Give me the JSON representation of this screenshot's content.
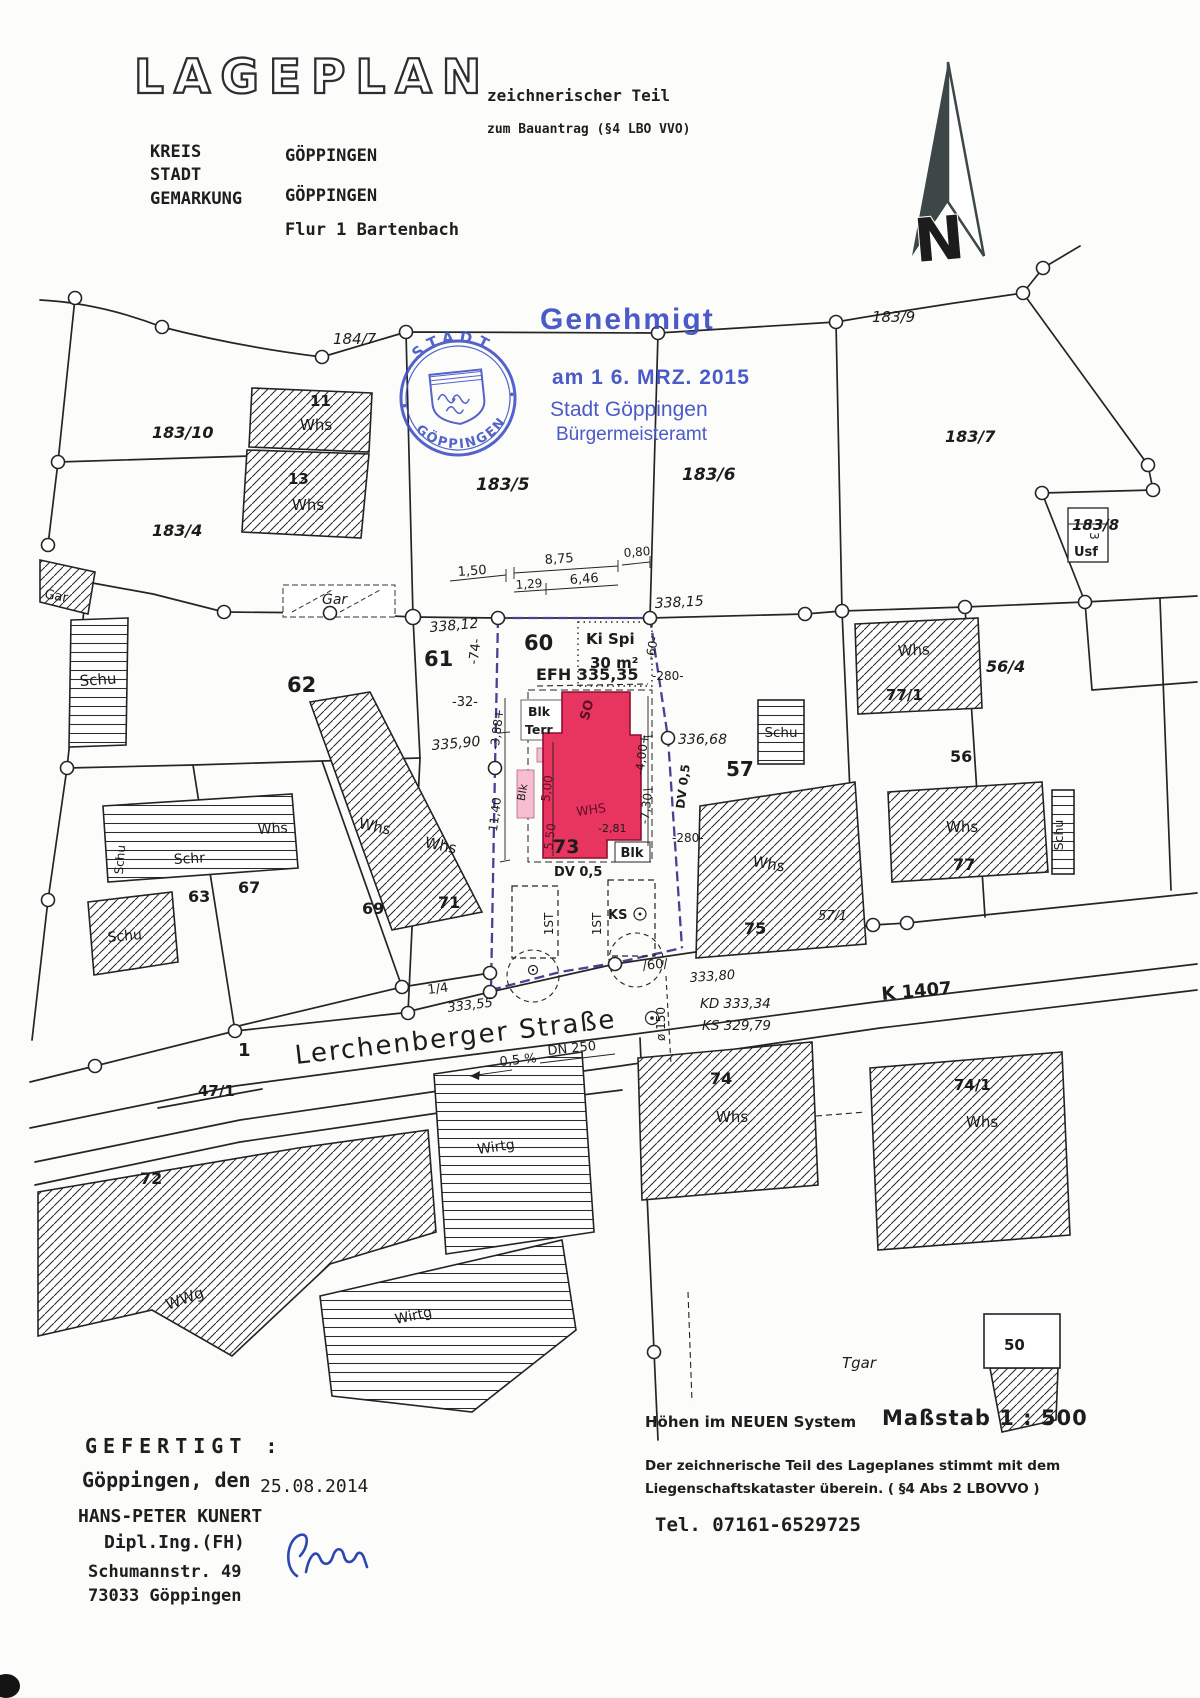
{
  "header": {
    "title": "LAGEPLAN",
    "subtitle": "zeichnerischer Teil",
    "subtitle2": "zum Bauantrag (§4 LBO VVO)",
    "kreis_label": "KREIS",
    "stadt_label": "STADT",
    "gemarkung_label": "GEMARKUNG",
    "kreis_value": "GÖPPINGEN",
    "gemarkung_value": "GÖPPINGEN",
    "flur_value": "Flur 1  Bartenbach"
  },
  "stamp": {
    "approved": "Genehmigt",
    "date_line": "am 1 6. MRZ. 2015",
    "authority": "Stadt Göppingen",
    "office": "Bürgermeisteramt",
    "seal_top": "STADT",
    "seal_bottom": "GÖPPINGEN",
    "color": "#3d4fc4"
  },
  "north": {
    "letter": "N"
  },
  "map": {
    "street_name": "Lerchenberger Straße",
    "road_k": "K 1407",
    "p184_7": "184/7",
    "p183_9": "183/9",
    "p183_10": "183/10",
    "p183_4": "183/4",
    "p183_5": "183/5",
    "p183_6": "183/6",
    "p183_7": "183/7",
    "p183_8": "183/8",
    "p56_4": "56/4",
    "p56": "56",
    "p57": "57",
    "p57_1": "57/1",
    "p60": "60",
    "p61": "61",
    "p62": "62",
    "p63": "63",
    "p67": "67",
    "p69": "69",
    "p71": "71",
    "p73": "73",
    "p75": "75",
    "p77": "77",
    "p77_1": "77/1",
    "p72": "72",
    "p74": "74",
    "p74_1": "74/1",
    "p50": "50",
    "p47_1": "47/1",
    "p1": "1",
    "p1_4": "1/4",
    "p11": "11",
    "p13": "13",
    "whs": "Whs",
    "whs_caps": "WHS",
    "schu": "Schu",
    "schr": "Schr",
    "gar": "Gar",
    "usf": "Usf",
    "usf_num": "3",
    "wwg": "WWg",
    "wirtg": "Wirtg",
    "tgar": "Tgar",
    "terr": "Terr",
    "blk": "Blk",
    "so": "SO",
    "st1": "1ST",
    "ks": "KS",
    "dv05": "DV 0,5",
    "kispi": "Ki Spi",
    "kispi_area": "30 m²",
    "efh": "EFH 335,35",
    "h338_12": "338,12",
    "h338_15": "338,15",
    "h335_90": "335,90",
    "h336_68": "336,68",
    "h333_55": "333,55",
    "h333_80": "333,80",
    "kd": "KD 333,34",
    "ks_height": "KS 329,79",
    "d150": "1,50",
    "d875": "8,75",
    "d080": "0,80",
    "d129": "1,29",
    "d646": "6,46",
    "d74": "-74-",
    "d60": "-60-",
    "d32": "-32-",
    "d280": "-280-",
    "d388": "-3,88+",
    "d1140": "11,40",
    "d500": "5,00",
    "d550": "5,50",
    "d281": "-2,81",
    "d400": "-4,00+",
    "d730": "-7,30",
    "slash60": "/60/",
    "dia150": "ø 150",
    "gradient": "0,5 %",
    "dn250": "DN 250"
  },
  "notes": {
    "heights": "Höhen im NEUEN System",
    "scale": "Maßstab  1 : 500",
    "statement1": "Der zeichnerische Teil des Lageplanes stimmt mit dem",
    "statement2": "Liegenschaftskataster überein. ( §4 Abs 2 LBOVVO )",
    "phone": "Tel.  07161-6529725"
  },
  "prepared": {
    "label": "GEFERTIGT :",
    "place_line": "Göppingen, den",
    "date": "25.08.2014",
    "name": "HANS-PETER KUNERT",
    "qualification": "Dipl.Ing.(FH)",
    "street": "Schumannstr. 49",
    "city": "73033 Göppingen"
  }
}
